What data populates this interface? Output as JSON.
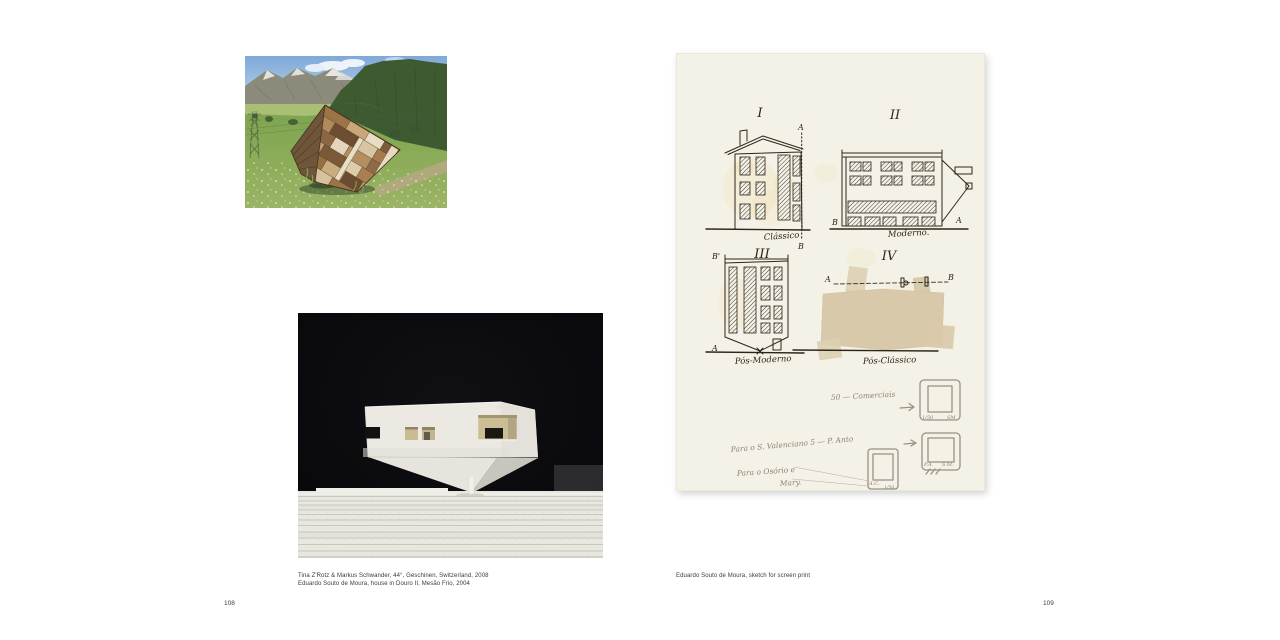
{
  "left_page": {
    "page_number": "108",
    "caption_line1": "Tina Z'Rotz & Markus Schwander, 44°, Geschinen, Switzerland, 2008",
    "caption_line2": "Eduardo Souto de Moura, house in Douro II, Mesão Frio, 2004"
  },
  "right_page": {
    "page_number": "109",
    "caption_line1": "Eduardo Souto de Moura, sketch for screen print",
    "sketch": {
      "numeral_i": "I",
      "numeral_ii": "II",
      "numeral_iii": "III",
      "numeral_iv": "IV",
      "label_classico": "Clássico",
      "label_moderno": "Moderno.",
      "label_pos_moderno": "Pós-Moderno",
      "label_pos_classico": "Pós-Clássico",
      "mark_a1": "A",
      "mark_b1": "B",
      "mark_b2": "B",
      "mark_a2": "A",
      "mark_b3": "B'",
      "mark_a3": "A",
      "mark_a4": "A",
      "mark_b4": "B",
      "note_edition": "50 — Comerciais",
      "note_dedication1": "Para o S. Valenciano 5 — P. Anto",
      "note_dedication2": "Para o Osório e",
      "note_dedication3": "Mary.",
      "frame1_scale": "1/50",
      "frame1_initials": "SM",
      "frame2_initials": "A.C.",
      "frame2_scale": "1/50",
      "frame3_initials": "P.A.",
      "frame3_initials2": "S.M."
    }
  },
  "colors": {
    "page_background": "#ffffff",
    "caption_text": "#3a3a3a",
    "sketch_paper": "#f4f1e6",
    "sketch_ink": "#2e2519",
    "pencil_gray": "#8b8376",
    "masking_tape": "#d9c9ab",
    "model_background": "#0a0a0c",
    "model_white": "#ebe9e2",
    "sky_blue": "#8fb5de",
    "forest_green": "#3d5a31",
    "meadow_green": "#86a957",
    "wood_brown": "#a87f54"
  }
}
